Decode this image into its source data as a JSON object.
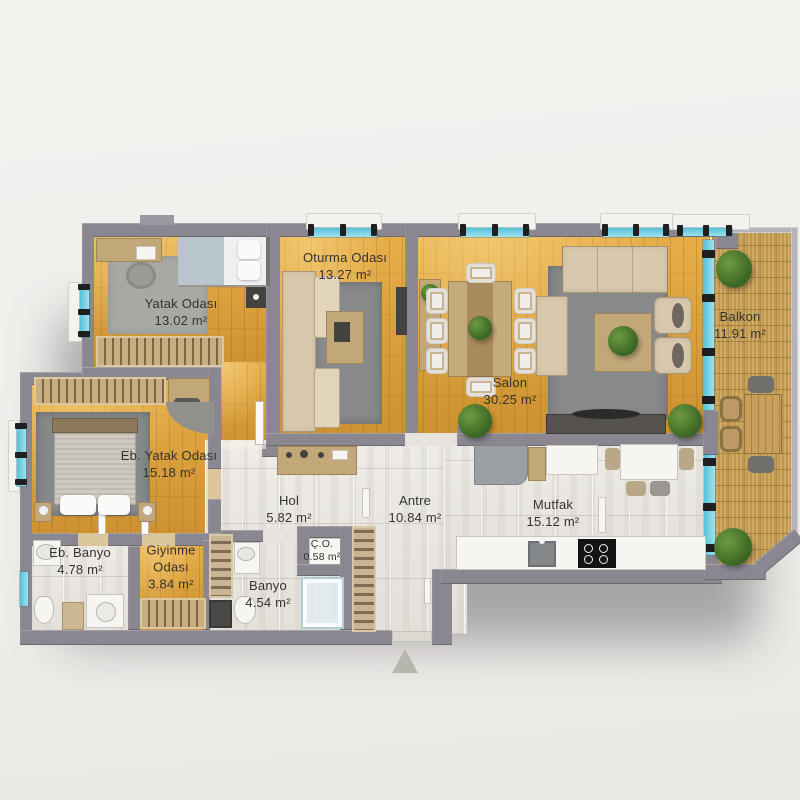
{
  "floor_plan": {
    "rooms": [
      {
        "name": "Yatak Odası",
        "area": "13.02 m²"
      },
      {
        "name": "Oturma Odası",
        "area": "13.27 m²"
      },
      {
        "name": "Salon",
        "area": "30.25 m²"
      },
      {
        "name": "Balkon",
        "area": "11.91 m²"
      },
      {
        "name": "Eb. Yatak Odası",
        "area": "15.18 m²"
      },
      {
        "name": "Hol",
        "area": "5.82 m²"
      },
      {
        "name": "Antre",
        "area": "10.84 m²"
      },
      {
        "name": "Mutfak",
        "area": "15.12 m²"
      },
      {
        "name": "Eb. Banyo",
        "area": "4.78 m²"
      },
      {
        "name": "Giyinme Odası",
        "area": "3.84 m²"
      },
      {
        "name": "Banyo",
        "area": "4.54 m²"
      },
      {
        "name": "Ç.O.",
        "area": "0.58 m²"
      }
    ],
    "icons": {
      "entrance_marker": "triangle-up"
    },
    "colors": {
      "wall": "#8b8791",
      "wood_floor": "#d9a03c",
      "tile_floor": "#e9e6e1",
      "balcony_deck": "#c79f55",
      "window_glass": "#7fd4e4",
      "rug": "#87898b",
      "background": "#f1efec",
      "entrance_marker": "#b6b6ad"
    }
  }
}
